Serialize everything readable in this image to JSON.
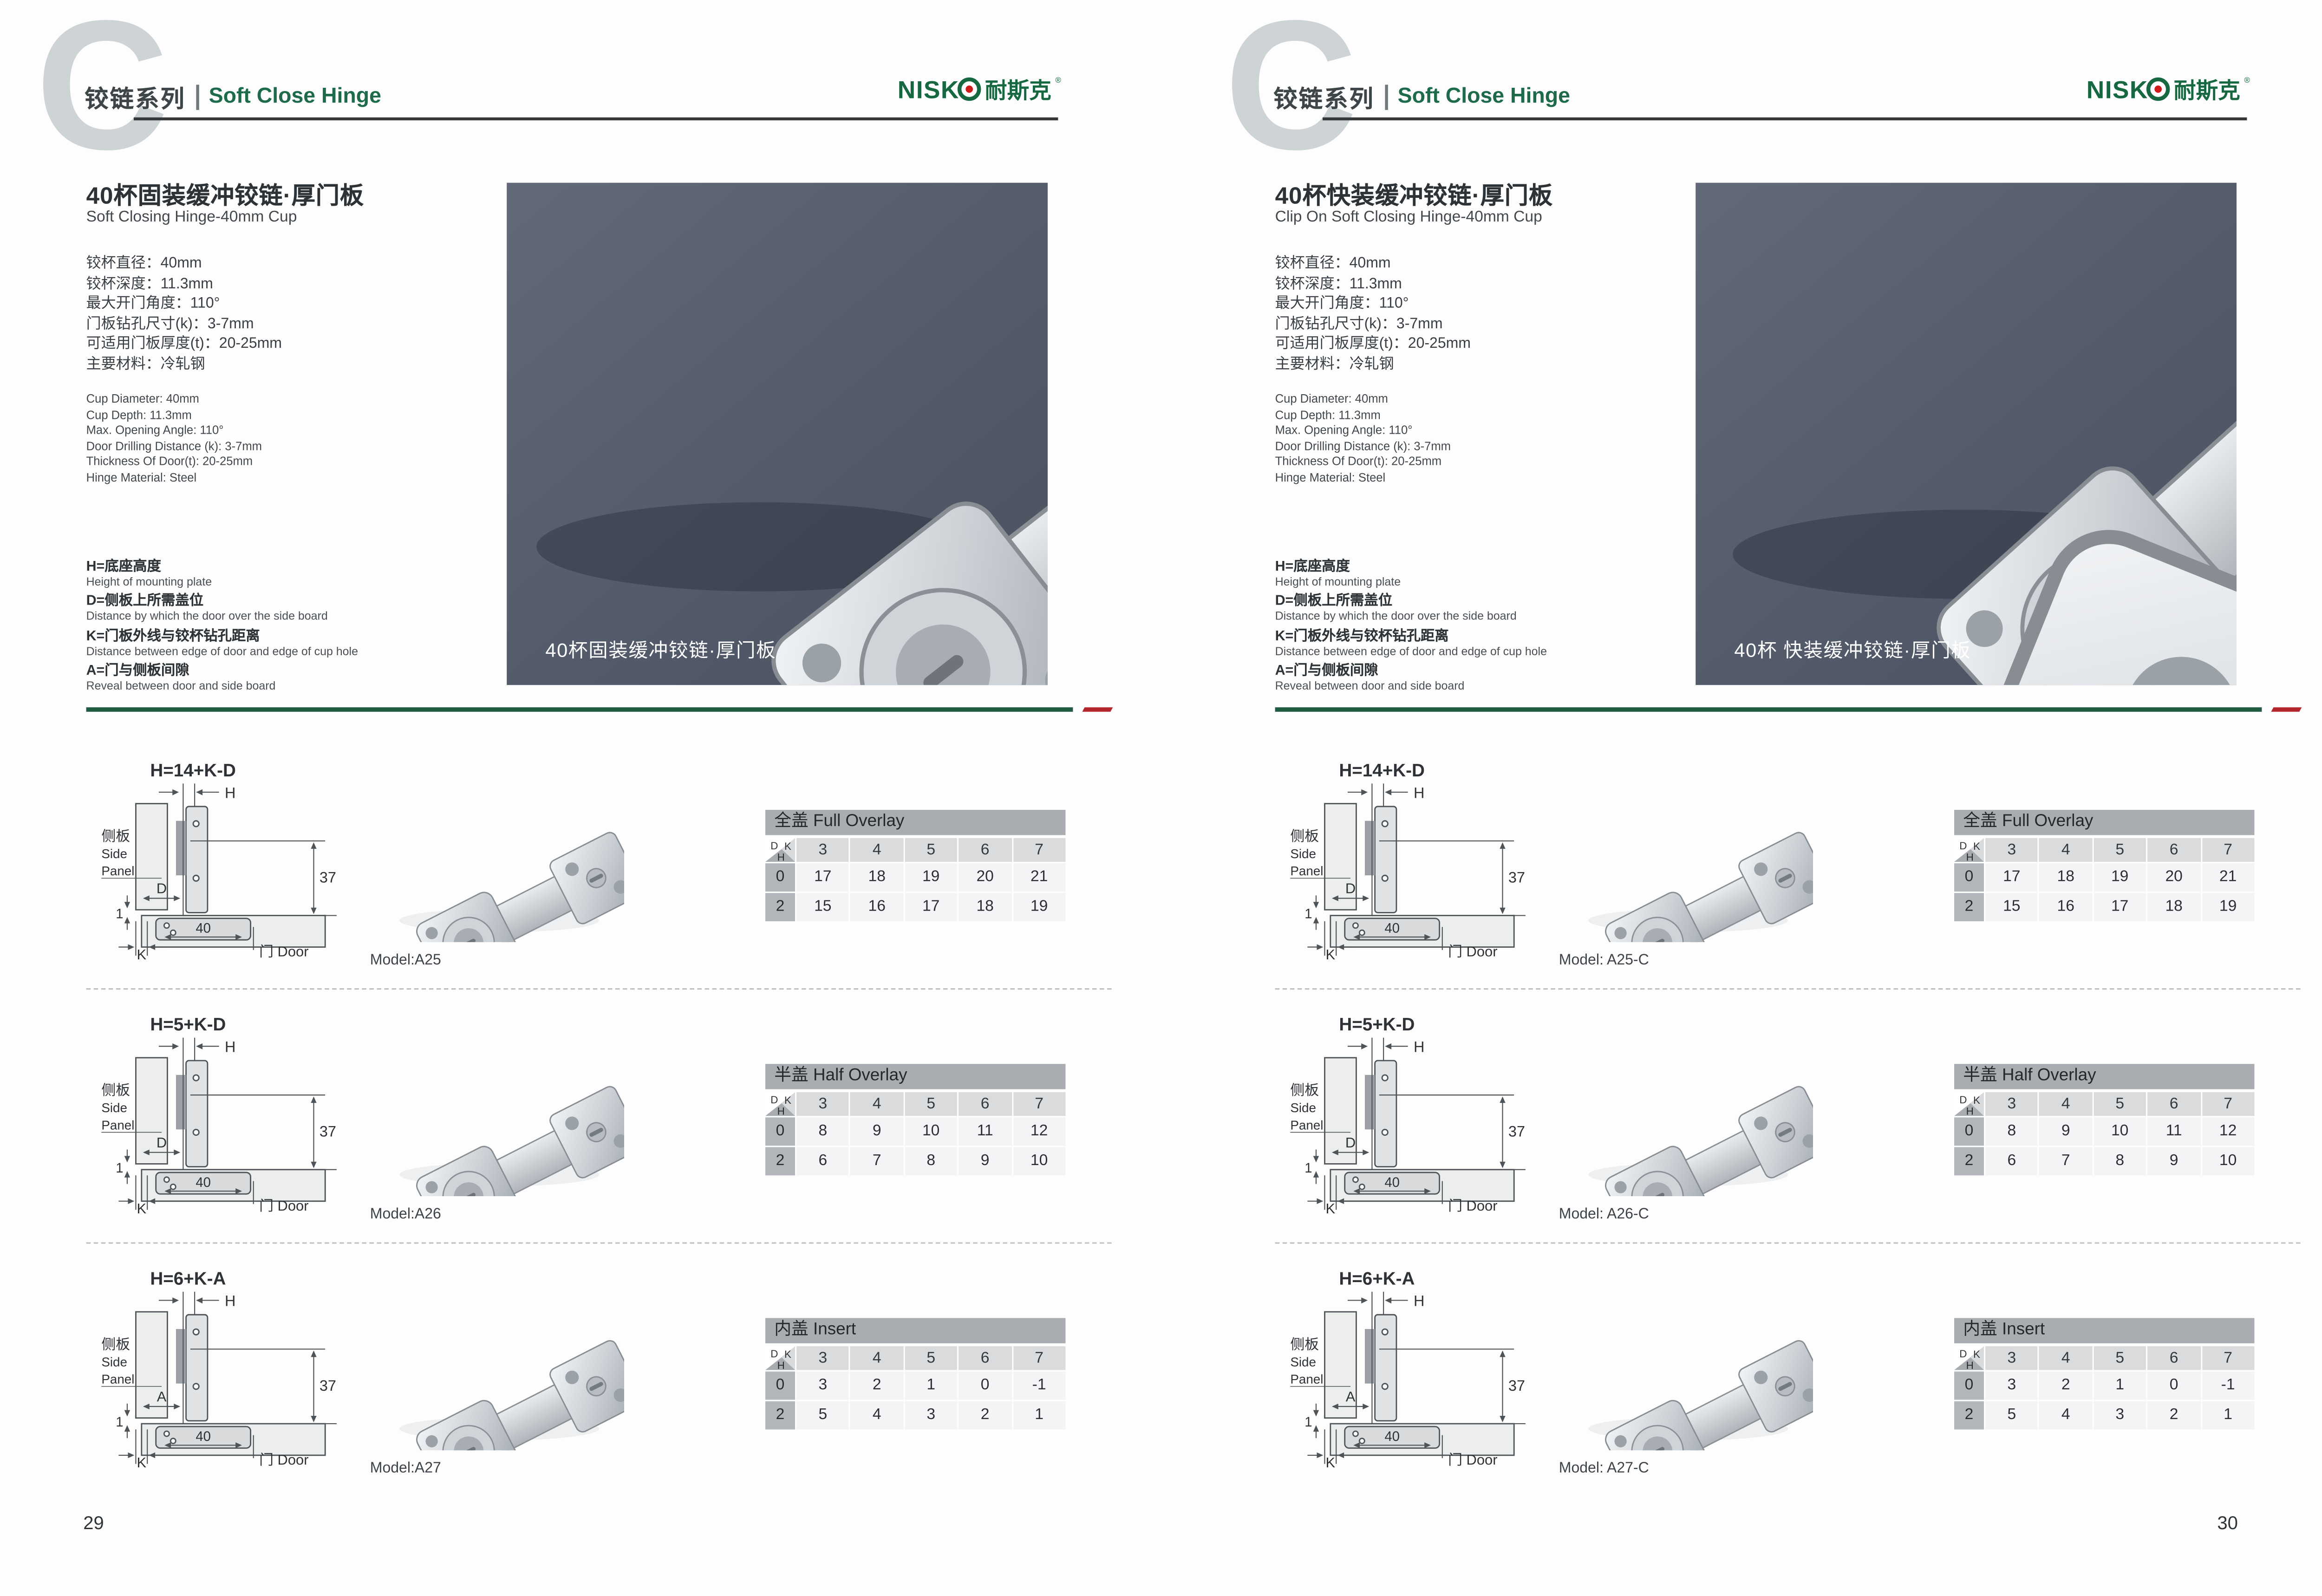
{
  "brand": {
    "latin": "NISK",
    "cn": "耐斯克",
    "reg": "®"
  },
  "colors": {
    "brand_green": "#15683f",
    "logo_dot_red": "#cf1a1b",
    "separator_green": "#1e5b41",
    "separator_red": "#b2262c",
    "photo_bg": "#565e6e",
    "table_title_bg": "#a9adb2",
    "table_colhead_bg": "#d9dbdd",
    "table_rowhead_bg": "#b2b5b9"
  },
  "diagram_labels": {
    "side_cn": "侧板",
    "side_en1": "Side",
    "side_en2": "Panel",
    "door": "门 Door",
    "h": "H",
    "k": "K",
    "one": "1",
    "forty": "40",
    "thirty_seven": "37"
  },
  "table_corner": {
    "d": "D",
    "k": "K",
    "h": "H"
  },
  "pages": [
    {
      "page_number": "29",
      "header": {
        "series_cn": "铰链系列",
        "series_en": "Soft Close Hinge"
      },
      "product": {
        "title_cn": "40杯固装缓冲铰链·厚门板",
        "title_en": "Soft Closing Hinge-40mm Cup",
        "specs_cn": [
          "铰杯直径：40mm",
          "铰杯深度：11.3mm",
          "最大开门角度：110°",
          "门板钻孔尺寸(k)：3-7mm",
          "可适用门板厚度(t)：20-25mm",
          "主要材料：冷轧钢"
        ],
        "specs_en": [
          "Cup Diameter: 40mm",
          "Cup Depth: 11.3mm",
          "Max. Opening Angle: 110°",
          "Door Drilling Distance (k): 3-7mm",
          "Thickness Of Door(t): 20-25mm",
          "Hinge Material: Steel"
        ],
        "definitions": [
          {
            "cn": "H=底座高度",
            "en": "Height of mounting plate"
          },
          {
            "cn": "D=侧板上所需盖位",
            "en": "Distance by which the door over the side board"
          },
          {
            "cn": "K=门板外线与铰杯钻孔距离",
            "en": "Distance between edge of door and edge of cup hole"
          },
          {
            "cn": "A=门与侧板间隙",
            "en": "Reveal between door and side board"
          }
        ],
        "photo_caption": "40杯固装缓冲铰链·厚门板"
      },
      "sections": [
        {
          "formula": "H=14+K-D",
          "dim_label": "D",
          "model": "Model:A25",
          "table": {
            "title": "全盖 Full Overlay",
            "k": [
              "3",
              "4",
              "5",
              "6",
              "7"
            ],
            "rows": [
              {
                "h": "0",
                "values": [
                  "17",
                  "18",
                  "19",
                  "20",
                  "21"
                ]
              },
              {
                "h": "2",
                "values": [
                  "15",
                  "16",
                  "17",
                  "18",
                  "19"
                ]
              }
            ]
          }
        },
        {
          "formula": "H=5+K-D",
          "dim_label": "D",
          "model": "Model:A26",
          "table": {
            "title": "半盖 Half Overlay",
            "k": [
              "3",
              "4",
              "5",
              "6",
              "7"
            ],
            "rows": [
              {
                "h": "0",
                "values": [
                  "8",
                  "9",
                  "10",
                  "11",
                  "12"
                ]
              },
              {
                "h": "2",
                "values": [
                  "6",
                  "7",
                  "8",
                  "9",
                  "10"
                ]
              }
            ]
          }
        },
        {
          "formula": "H=6+K-A",
          "dim_label": "A",
          "model": "Model:A27",
          "table": {
            "title": "内盖 Insert",
            "k": [
              "3",
              "4",
              "5",
              "6",
              "7"
            ],
            "rows": [
              {
                "h": "0",
                "values": [
                  "3",
                  "2",
                  "1",
                  "0",
                  "-1"
                ]
              },
              {
                "h": "2",
                "values": [
                  "5",
                  "4",
                  "3",
                  "2",
                  "1"
                ]
              }
            ]
          }
        }
      ]
    },
    {
      "page_number": "30",
      "header": {
        "series_cn": "铰链系列",
        "series_en": "Soft Close Hinge"
      },
      "product": {
        "title_cn": "40杯快装缓冲铰链·厚门板",
        "title_en": "Clip On Soft Closing Hinge-40mm Cup",
        "specs_cn": [
          "铰杯直径：40mm",
          "铰杯深度：11.3mm",
          "最大开门角度：110°",
          "门板钻孔尺寸(k)：3-7mm",
          "可适用门板厚度(t)：20-25mm",
          "主要材料：冷轧钢"
        ],
        "specs_en": [
          "Cup Diameter: 40mm",
          "Cup Depth: 11.3mm",
          "Max. Opening Angle: 110°",
          "Door Drilling Distance (k): 3-7mm",
          "Thickness Of Door(t): 20-25mm",
          "Hinge Material: Steel"
        ],
        "definitions": [
          {
            "cn": "H=底座高度",
            "en": "Height of mounting plate"
          },
          {
            "cn": "D=侧板上所需盖位",
            "en": "Distance by which the door over the side board"
          },
          {
            "cn": "K=门板外线与铰杯钻孔距离",
            "en": "Distance between edge of door and edge of cup hole"
          },
          {
            "cn": "A=门与侧板间隙",
            "en": "Reveal between door and side board"
          }
        ],
        "photo_caption": "40杯 快装缓冲铰链·厚门板"
      },
      "sections": [
        {
          "formula": "H=14+K-D",
          "dim_label": "D",
          "model": "Model: A25-C",
          "table": {
            "title": "全盖 Full Overlay",
            "k": [
              "3",
              "4",
              "5",
              "6",
              "7"
            ],
            "rows": [
              {
                "h": "0",
                "values": [
                  "17",
                  "18",
                  "19",
                  "20",
                  "21"
                ]
              },
              {
                "h": "2",
                "values": [
                  "15",
                  "16",
                  "17",
                  "18",
                  "19"
                ]
              }
            ]
          }
        },
        {
          "formula": "H=5+K-D",
          "dim_label": "D",
          "model": "Model: A26-C",
          "table": {
            "title": "半盖 Half Overlay",
            "k": [
              "3",
              "4",
              "5",
              "6",
              "7"
            ],
            "rows": [
              {
                "h": "0",
                "values": [
                  "8",
                  "9",
                  "10",
                  "11",
                  "12"
                ]
              },
              {
                "h": "2",
                "values": [
                  "6",
                  "7",
                  "8",
                  "9",
                  "10"
                ]
              }
            ]
          }
        },
        {
          "formula": "H=6+K-A",
          "dim_label": "A",
          "model": "Model: A27-C",
          "table": {
            "title": "内盖 Insert",
            "k": [
              "3",
              "4",
              "5",
              "6",
              "7"
            ],
            "rows": [
              {
                "h": "0",
                "values": [
                  "3",
                  "2",
                  "1",
                  "0",
                  "-1"
                ]
              },
              {
                "h": "2",
                "values": [
                  "5",
                  "4",
                  "3",
                  "2",
                  "1"
                ]
              }
            ]
          }
        }
      ]
    }
  ]
}
